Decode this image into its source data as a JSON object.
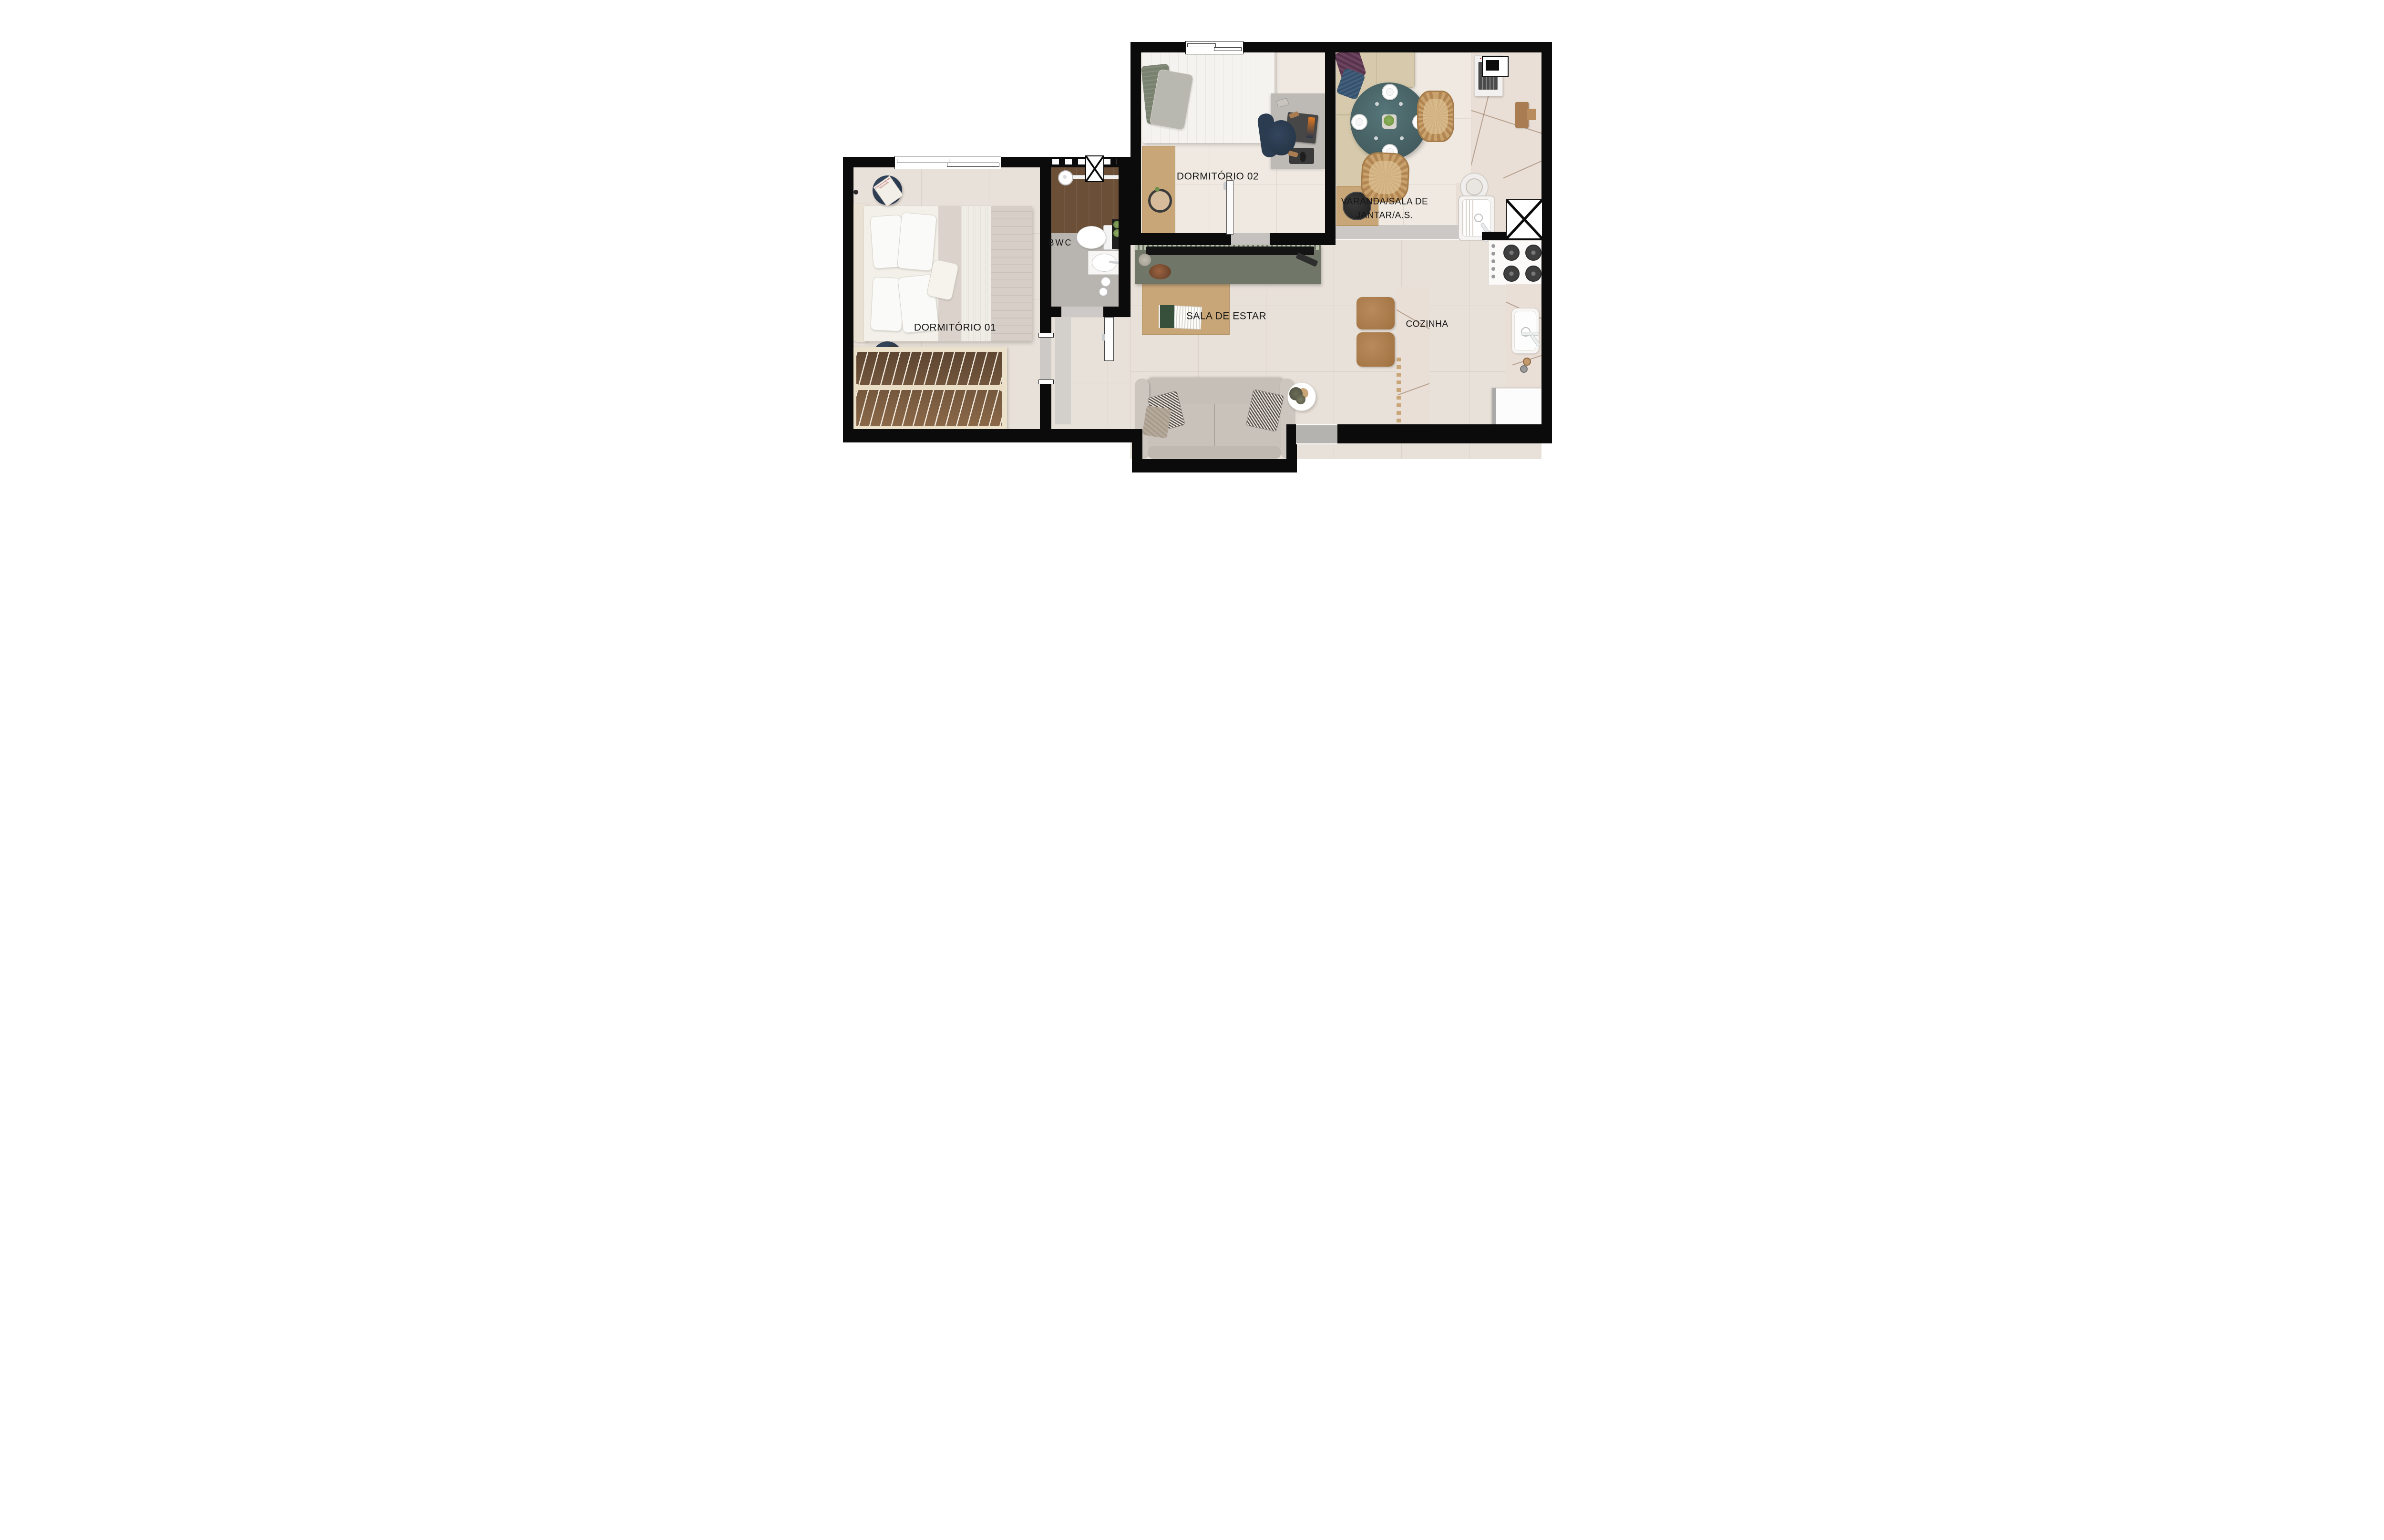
{
  "plan": {
    "rooms": {
      "dormitorio1": {
        "label": "DORMITÓRIO 01"
      },
      "dormitorio2": {
        "label": "DORMITÓRIO 02"
      },
      "bwc": {
        "label": "BWC"
      },
      "varanda": {
        "label": "VARANDA/SALA DE\nJANTAR/A.S."
      },
      "sala": {
        "label": "SALA DE ESTAR"
      },
      "cozinha": {
        "label": "COZINHA"
      }
    },
    "decor": {
      "book_title": "STEPHEN KING MR. MERCEDES"
    },
    "colors": {
      "wall": "#0b0b0b",
      "floor-warm": "#e8e1d9",
      "floor-light": "#efe9e2",
      "floor-tile": "#b8b4af",
      "wood-dark": "#6b4f37",
      "wood-light": "#c9a678",
      "wood-mid": "#a97c52",
      "marble": "#e9dfd6",
      "teal": "#4a686b",
      "sage": "#707768",
      "sage-light": "#b7c1ac",
      "navy": "#2c3c50",
      "sofa": "#c9c2bb",
      "cushion": "#d7caac",
      "gray-door": "#b5b3b0",
      "threshold": "#cbc8c5"
    }
  }
}
